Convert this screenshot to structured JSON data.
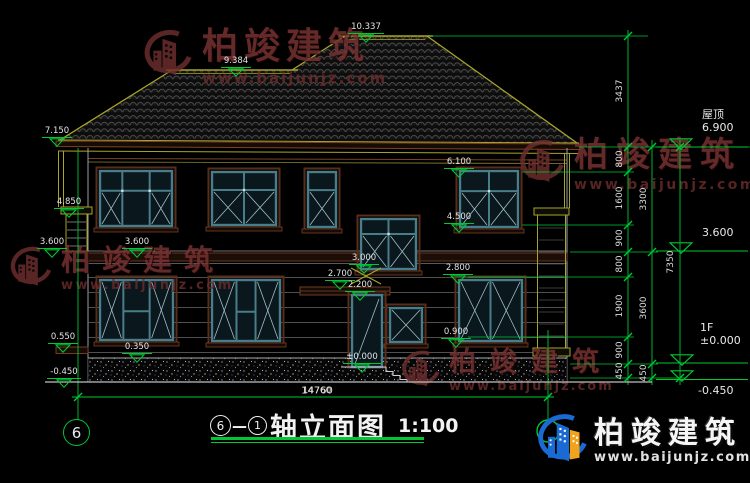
{
  "watermark": {
    "name": "柏竣建筑",
    "url": "www.baijunjz.com"
  },
  "brand_logo": {
    "name": "柏竣建筑",
    "url": "www.baijunjz.com"
  },
  "title_block": {
    "axis_from": "6",
    "dash": "—",
    "axis_to": "1",
    "text": "轴立面图",
    "scale": "1:100"
  },
  "axis_bubble": {
    "label": "6"
  },
  "bottom_dim": {
    "label": "14760"
  },
  "elevation_markers": [
    {
      "label": "10.337",
      "x": 366,
      "y": 36
    },
    {
      "label": "9.384",
      "x": 236,
      "y": 70
    },
    {
      "label": "7.150",
      "x": 57,
      "y": 140
    },
    {
      "label": "4.850",
      "x": 69,
      "y": 211
    },
    {
      "label": "3.600",
      "x": 52,
      "y": 251
    },
    {
      "label": "3.600",
      "x": 137,
      "y": 251
    },
    {
      "label": "6.100",
      "x": 459,
      "y": 171
    },
    {
      "label": "4.500",
      "x": 459,
      "y": 226
    },
    {
      "label": "2.800",
      "x": 458,
      "y": 277
    },
    {
      "label": "0.900",
      "x": 456,
      "y": 341
    },
    {
      "label": "3.000",
      "x": 364,
      "y": 267
    },
    {
      "label": "2.700",
      "x": 340,
      "y": 283
    },
    {
      "label": "2.200",
      "x": 360,
      "y": 294
    },
    {
      "label": "0.550",
      "x": 63,
      "y": 346
    },
    {
      "label": "0.350",
      "x": 137,
      "y": 356
    },
    {
      "label": "-0.450",
      "x": 64,
      "y": 381
    },
    {
      "label": "±0.000",
      "x": 362,
      "y": 366
    }
  ],
  "level_markers_right": [
    {
      "name": "屋顶",
      "value": "6.900",
      "x": 681,
      "y": 147,
      "tx": 702,
      "ty": 109
    },
    {
      "name": "",
      "value": "3.600",
      "x": 681,
      "y": 251,
      "tx": 702,
      "ty": 227
    },
    {
      "name": "1F",
      "value": "±0.000",
      "x": 682,
      "y": 363,
      "tx": 700,
      "ty": 322
    },
    {
      "name": "",
      "value": "-0.450",
      "x": 682,
      "y": 379,
      "tx": 698,
      "ty": 385
    }
  ],
  "dim_labels": [
    {
      "text": "3437",
      "x": 620,
      "y": 91,
      "rot": true
    },
    {
      "text": "800",
      "x": 620,
      "y": 159,
      "rot": true
    },
    {
      "text": "1600",
      "x": 620,
      "y": 198,
      "rot": true
    },
    {
      "text": "900",
      "x": 620,
      "y": 238,
      "rot": true
    },
    {
      "text": "800",
      "x": 620,
      "y": 264,
      "rot": true
    },
    {
      "text": "1900",
      "x": 620,
      "y": 306,
      "rot": true
    },
    {
      "text": "900",
      "x": 620,
      "y": 350,
      "rot": true
    },
    {
      "text": "450",
      "x": 620,
      "y": 371,
      "rot": true
    },
    {
      "text": "3300",
      "x": 644,
      "y": 199,
      "rot": true
    },
    {
      "text": "3600",
      "x": 644,
      "y": 308,
      "rot": true
    },
    {
      "text": "450",
      "x": 644,
      "y": 373,
      "rot": true
    },
    {
      "text": "7350",
      "x": 671,
      "y": 262,
      "rot": true
    },
    {
      "text": "14760",
      "x": 317,
      "y": 391,
      "rot": false
    }
  ]
}
